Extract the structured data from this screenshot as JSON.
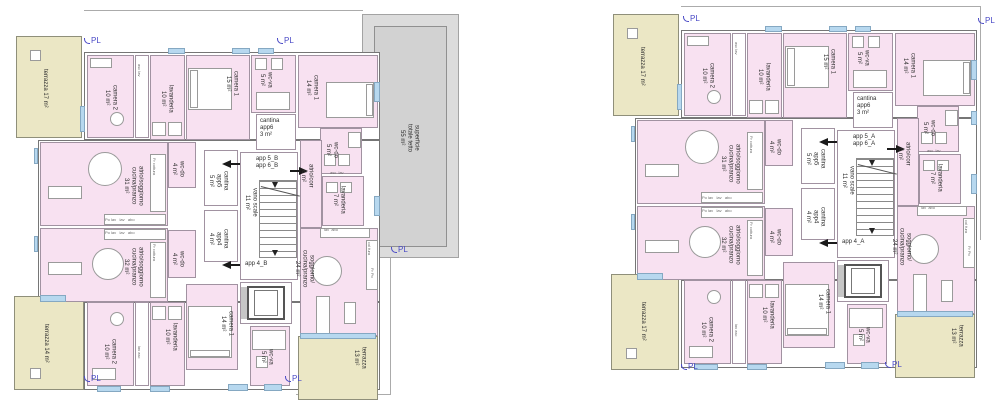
{
  "colors": {
    "room_pink": "#f8e1f1",
    "terrace_beige": "#ebe7c5",
    "window_blue": "#b7d8ef",
    "roof_gray": "#d2d2d2",
    "wall_gray": "#767676",
    "pl_blue": "#4a4ac6"
  },
  "pl": "PL",
  "plans": {
    "left": {
      "labels": {
        "terrazza_top": "terrazza 17 m²",
        "camera2_top": "camera 2\n10 m²",
        "asc_top": "asc  lav",
        "lavanderia_top": "lavanderia\n10 m²",
        "camera1_15": "camera 1\n15 m²",
        "wcva_top": "wc-va\n5 m²",
        "cantina_app6": "cantina\napp6\n3 m²",
        "camera1_14_top": "camera 1\n14 m²",
        "wcdo_5": "wc-do\n5 m²",
        "lavanderia_7": "lavanderia\n7 m²",
        "asc_7": "asc  lav",
        "atrio_31": "atrio/soggiorno\ncucina/pranzo\n31 m²",
        "wcdo_4a": "wc-do\n4 m²",
        "cantina_app5": "cantina\napp5\n5 m²",
        "vano_scale": "vano scale\n11 m²",
        "app_56": "app 5_B\napp 6_B",
        "cantina_app4": "cantina\napp4\n4 m²",
        "app_4": "app 4_B",
        "atrio_corr": "atrio/corr\n6 m²",
        "soggiorno_24": "soggiorno/\ncucina/pranzo\n24 m²",
        "atrio_32": "atrio/soggiorno\ncucina/pranzo\n32 m²",
        "wcdo_4b": "wc-do\n4 m²",
        "camera1_14_bot": "camera 1\n14 m²",
        "camera2_bot": "camera 2\n10 m²",
        "asc_bot": "lav  asc",
        "lavanderia_bot": "lavanderia\n10 m²",
        "wcva_bot": "wc-va\n5 m²",
        "terrazza_bot": "terrazza 14 m²",
        "terrazza_13": "terrazza\n13 m²",
        "roof": "superficie\ntotale tetto\n55 m²",
        "kitchen_row_31": "Po lav   lav   abo",
        "kitchen_side_31": "Fr  cottura",
        "kitchen_row_32": "Po lav   lav   abo",
        "kitchen_side_32": "Fr  cottura",
        "kitchen_24_top": "lav  abo",
        "kitchen_24_side1": "col  fura",
        "kitchen_24_side2": "Fr   Po"
      }
    },
    "right": {
      "labels": {
        "terrazza_top": "terrazza 17 m²",
        "camera2_top": "camera 2\n10 m²",
        "asc_top": "asc  lav",
        "lavanderia_top": "lavanderia\n10 m²",
        "camera1_15": "camera 1\n15 m²",
        "wcva_top": "wc-va\n5 m²",
        "cantina_app6": "cantina\napp6\n3 m²",
        "camera1_14_top": "camera 1\n14 m²",
        "wcdo_5": "wc-do\n5 m²",
        "lavanderia_7": "lavanderia\n7 m²",
        "asc_7": "asc  lav",
        "atrio_31": "atrio/soggiorno\ncucina/pranzo\n31 m²",
        "wcdo_4a": "wc-do\n4 m²",
        "cantina_app5": "cantina\napp5\n5 m²",
        "vano_scale": "vano scale\n11 m²",
        "app_56": "app 5_A\napp 6_A",
        "cantina_app4": "cantina\napp4\n4 m²",
        "app_4": "app 4_A",
        "atrio_corr": "atrio/corr\n6 m²",
        "soggiorno_24": "soggiorno/\ncucina/pranzo\n24 m²",
        "atrio_32": "atrio/soggiorno\ncucina/pranzo\n32 m²",
        "wcdo_4b": "wc-do\n4 m²",
        "camera1_14_bot": "camera 1\n14 m²",
        "camera2_bot": "camera 2\n10 m²",
        "asc_bot": "lav  asc",
        "lavanderia_bot": "lavanderia\n10 m²",
        "wcva_bot": "wc-va\n5 m²",
        "terrazza_bot": "terrazza 17 m²",
        "terrazza_13": "terrazza\n13 m²",
        "kitchen_row_31": "Po lav   lav   abo",
        "kitchen_side_31": "Fr  cottura",
        "kitchen_row_32": "Po lav   lav   abo",
        "kitchen_side_32": "Fr  cottura",
        "kitchen_24_top": "lav  abo",
        "kitchen_24_side1": "col  fura",
        "kitchen_24_side2": "Fr   Po"
      }
    }
  }
}
